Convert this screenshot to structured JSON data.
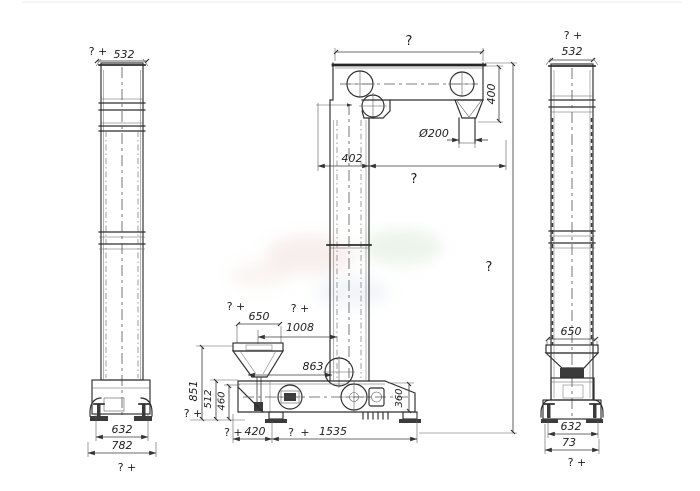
{
  "drawing": {
    "line_color": "#2d2d2d",
    "background": "#ffffff"
  },
  "left_view": {
    "top_note": "? +",
    "top_width": "532",
    "base_inner_width": "632",
    "base_outer_width": "782",
    "bottom_note": "? +"
  },
  "front_view": {
    "overall_width": "?",
    "head_height": "400",
    "spout_diameter": "Ø200",
    "head_offset": "402",
    "head_span": "?",
    "overall_height": "?",
    "hopper_note": "? +",
    "hopper_width": "650",
    "inlet_note": "? +",
    "inlet_span": "1008",
    "pulley_span": "863",
    "inlet_height": "851",
    "boot_upper_height": "512",
    "boot_height": "460",
    "drive_height": "360",
    "base_left_note": "?",
    "base_left_plus": "+",
    "base_left_span": "420",
    "base_right_note": "?",
    "base_right_plus": "+",
    "base_right_span": "1535",
    "ground_note": "? +"
  },
  "right_view": {
    "top_note": "? +",
    "top_width": "532",
    "hopper_width": "650",
    "base_inner_width": "632",
    "base_outer_width": "73",
    "bottom_note": "? +"
  }
}
